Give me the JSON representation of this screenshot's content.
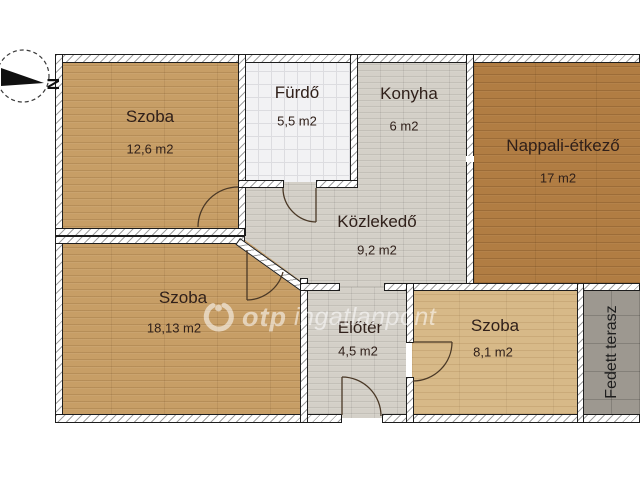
{
  "plan": {
    "title": "floor-plan",
    "rooms": [
      {
        "id": "szoba-1",
        "name": "Szoba",
        "area": "12,6 m2"
      },
      {
        "id": "furdo",
        "name": "Fürdő",
        "area": "5,5 m2"
      },
      {
        "id": "konyha",
        "name": "Konyha",
        "area": "6 m2"
      },
      {
        "id": "nappali-etkezo",
        "name": "Nappali-étkező",
        "area": "17 m2"
      },
      {
        "id": "kozlekedo",
        "name": "Közlekedő",
        "area": "9,2 m2"
      },
      {
        "id": "szoba-2",
        "name": "Szoba",
        "area": "18,13 m2"
      },
      {
        "id": "eloter",
        "name": "Előtér",
        "area": "4,5 m2"
      },
      {
        "id": "szoba-3",
        "name": "Szoba",
        "area": "8,1 m2"
      },
      {
        "id": "fedett-terasz",
        "name": "Fedett terasz",
        "area": ""
      }
    ],
    "compass": {
      "north_label": "N"
    },
    "watermark": {
      "brand": "otp",
      "suffix": "ingatlanpont"
    },
    "colors": {
      "wood_tan": "#c79e66",
      "wood_light": "#d7b988",
      "wood_dark": "#b17d43",
      "floor_gray": "#d4d0c8",
      "tile_white": "#f2f2f4",
      "terrace_gray": "#9d9890",
      "wall_line": "#1d1d1d",
      "label_text": "#30201a"
    }
  }
}
